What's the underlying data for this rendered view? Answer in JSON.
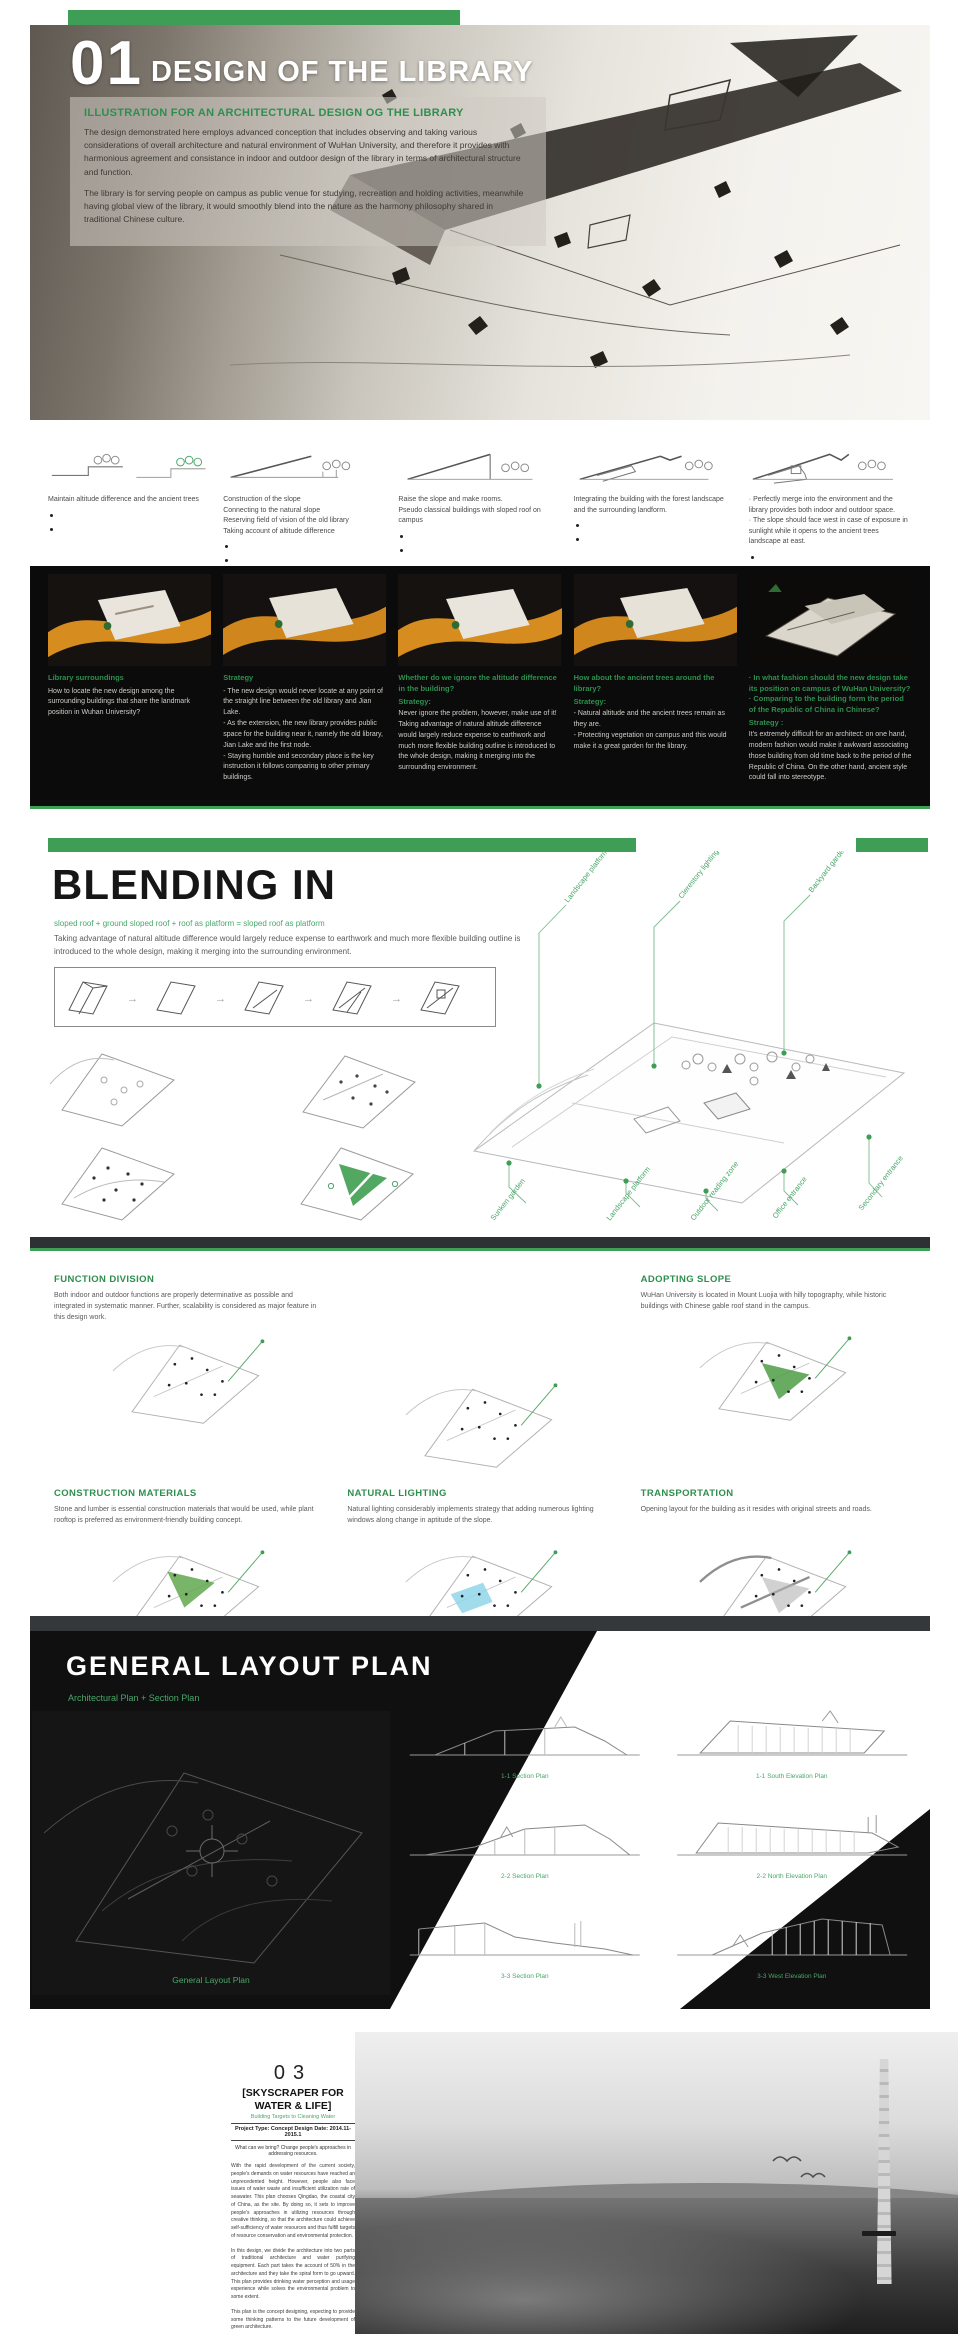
{
  "meta": {
    "accent_green": "#3f9e55",
    "band_black": "#0b0b0b"
  },
  "sec1": {
    "number": "01",
    "title": "DESIGN OF THE LIBRARY",
    "heading": "ILLUSTRATION FOR AN ARCHITECTURAL DESIGN OG THE LIBRARY",
    "para1": "The design demonstrated here employs advanced conception that includes observing and taking various considerations of overall architecture and natural environment of WuHan University, and therefore it provides with harmonious agreement and consistance in indoor and outdoor design of the library in terms of architectural structure and function.",
    "para2": "The library is for serving people on campus as public venue for studying, recreation and holding activities, meanwhile having global view of the library, it would smoothly blend into the nature as the harmony philosophy shared in traditional Chinese culture."
  },
  "process": {
    "steps": [
      {
        "caption": "Maintain altitude difference and the ancient trees",
        "heading": "Library surroundings",
        "sub": "",
        "body": "How to locate the new design among the surrounding buildings that share the landmark position in Wuhan University?"
      },
      {
        "caption": "Construction of the slope\nConnecting to the natural slope\nReserving field of vision of the old library\nTaking account of altitude difference",
        "heading": "Strategy",
        "sub": "",
        "body": "- The new design would never locate at any point of the straight line between the old library and Jian Lake.\n- As the extension, the new library provides public space for the building near it, namely the old library, Jian Lake and the first node.\n- Staying humble and secondary place is the key instruction it follows comparing to other primary buildings."
      },
      {
        "caption": "Raise the slope and make rooms.\nPseudo classical buildings with sloped roof on campus",
        "heading": "Whether do we ignore the altitude difference in the building?",
        "sub": "Strategy:",
        "body": "Never ignore the problem, however, make use of it!  Taking advantage of natural altitude difference would largely reduce expense to earthwork and much more flexible building outline is introduced to the whole design, making it merging into the surrounding environment."
      },
      {
        "caption": "Integrating the building with the forest landscape and the surrounding landform.",
        "heading": "How about the ancient trees around the library?",
        "sub": "Strategy:",
        "body": "- Natural altitude and the ancient trees remain as they are.\n- Protecting vegetation on campus and this would make it a great garden for the library."
      },
      {
        "caption": "· Perfectly merge into the environment and the library provides both indoor and outdoor space.\n· The slope should face west in case of exposure in sunlight while it opens to the ancient trees landscape at east.",
        "heading": "· In what fashion should the new design take its position on campus of WuHan University?\n· Comparing to the building form the period of the Republic of China in Chinese?",
        "sub": "Strategy :",
        "body": "It's extremely difficult for an architect: on one hand, modern fashion would make it awkward associating those building from old time back to the period of the Republic of China. On the other hand, ancient style could fall into stereotype."
      }
    ]
  },
  "blending": {
    "title": "BLENDING IN",
    "formula": "sloped roof + ground sloped roof + roof as platform = sloped roof as platform",
    "desc": "Taking advantage of natural altitude difference would largely reduce expense to earthwork and much more flexible building outline is introduced to the whole design, making it merging into the surrounding environment.",
    "labels_top": [
      "Landscape platform",
      "Clerestory lighting",
      "Backyard garden"
    ],
    "labels_bottom": [
      "Sunken garden",
      "Landscape platform",
      "Outdoor reading zone",
      "Office entrance",
      "Secondary entrance"
    ]
  },
  "panels": {
    "items": [
      {
        "title": "FUNCTION DIVISION",
        "body": "Both indoor and outdoor functions are properly determinative as possible and integrated in systematic manner. Further, scalability is considered as major feature in this design work.",
        "patch": "transparent"
      },
      {
        "title": "",
        "body": "",
        "patch": "transparent"
      },
      {
        "title": "ADOPTING SLOPE",
        "body": "WuHan University is located in Mount Luojia with hilly topography, while historic buildings with Chinese gable roof stand in the campus.",
        "patch": "#4d9e45"
      },
      {
        "title": "CONSTRUCTION MATERIALS",
        "body": "Stone and lumber is essential construction materials that would be used, while plant rooftop is preferred as environment-friendly building concept.",
        "patch": "#62a84e"
      },
      {
        "title": "NATURAL LIGHTING",
        "body": "Natural lighting considerably implements strategy that adding numerous lighting windows along change in aptitude of the slope.",
        "patch": "#8fd6e8"
      },
      {
        "title": "TRANSPORTATION",
        "body": "Opening layout for the building as it resides with original streets and roads.",
        "patch": "#b3b3b3"
      }
    ]
  },
  "layout": {
    "title": "GENERAL LAYOUT PLAN",
    "subtitle": "Architectural Plan + Section Plan",
    "plan_label": "General Layout Plan",
    "drawings": [
      "1-1 Section Plan",
      "1-1 South Elevation Plan",
      "2-2 Section Plan",
      "2-2 North Elevation Plan",
      "3-3 Section Plan",
      "3-3 West Elevation Plan"
    ]
  },
  "sky": {
    "number": "03",
    "title": "[SKYSCRAPER FOR WATER & LIFE]",
    "subtitle": "Building Targets to Cleaning Water",
    "meta": "Project Type: Concept Design  Date: 2014.11-2015.1",
    "intro": "What can we bring? Change people's approaches in addressing resources.",
    "para1": "With the rapid development of the current society, people's demands on water resources have reached an unprecedented height. However, people also face issues of water waste and insufficient utilization rate of seawater. This plan chooses Qingdao, the coastal city of China, as the site. By doing so, it sets to improve people's approaches in utilizing resources through creative thinking, so that the architecture could achieve self-sufficiency of water resources and thus fulfill targets of resource conservation and environmental protection.",
    "para2": "In this design, we divide the architecture into two parts of traditional architecture and water purifying equipment. Each part takes the account of 50% in the architecture and they take the spiral form to go upward. This plan provides drinking water perception and usage experience while solves the environmental problem to some extent.",
    "para3": "This plan is the concept designing, expecting to provide some thinking patterns to the future development of green architecture."
  }
}
